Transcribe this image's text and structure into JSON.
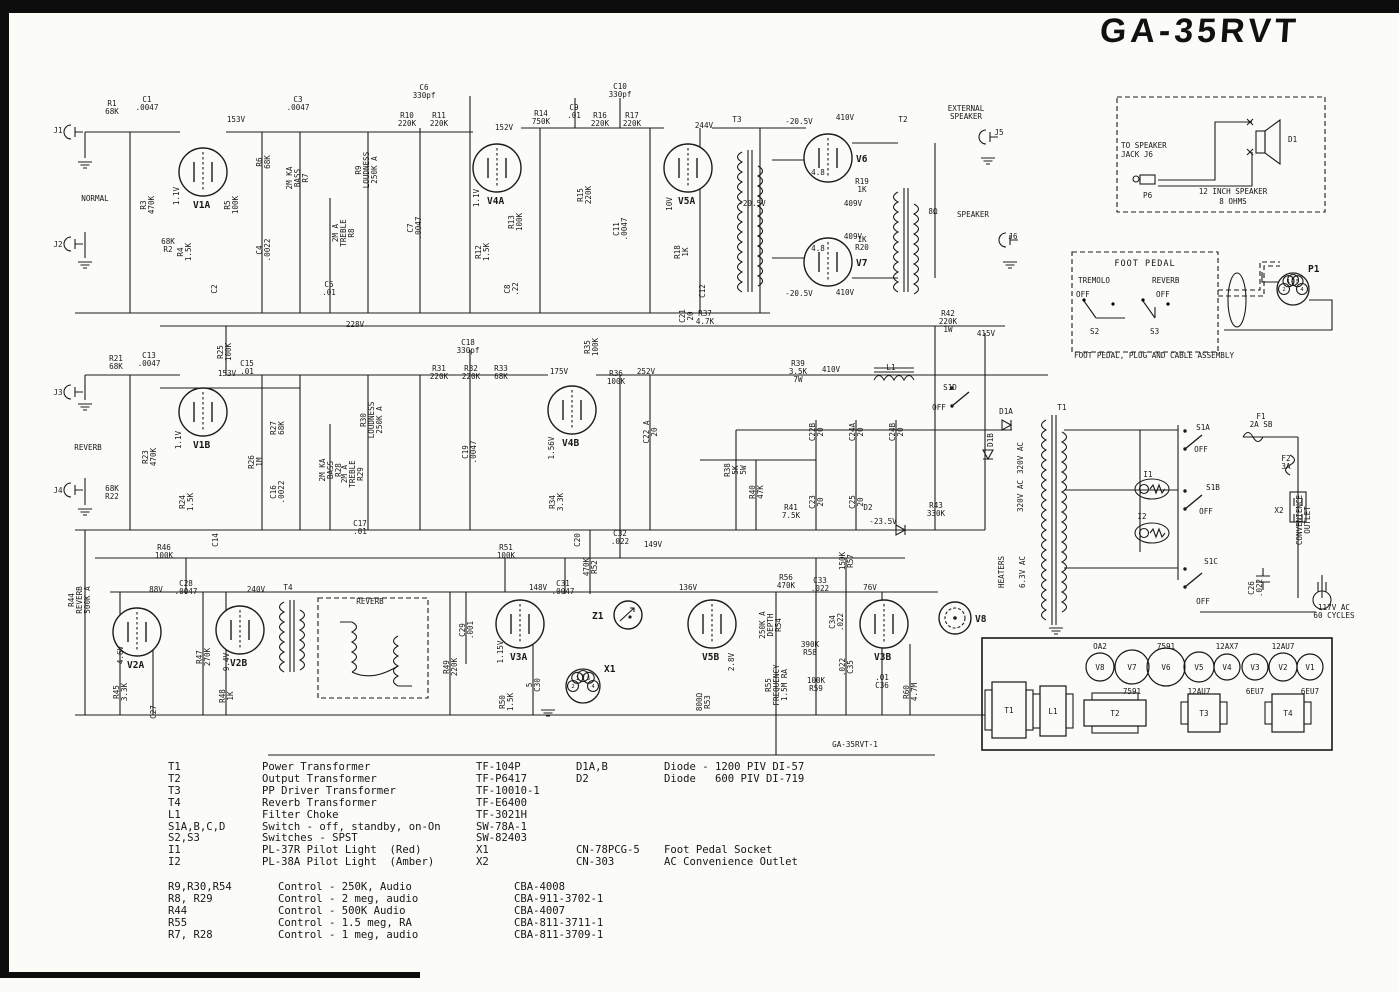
{
  "title": "GA-35RVT",
  "page_note": "GA-35RVT-1",
  "speaker_assembly": {
    "line1": "TO SPEAKER",
    "line2": "JACK J6",
    "plug": "P6",
    "driver": "D1",
    "spec1": "12 INCH SPEAKER",
    "spec2": "8 OHMS"
  },
  "foot_pedal": {
    "title": "FOOT PEDAL",
    "left_label": "TREMOLO",
    "right_label": "REVERB",
    "off_left": "OFF",
    "off_right": "OFF",
    "s2": "S2",
    "s3": "S3",
    "plug": "P1",
    "caption": "FOOT PEDAL, PLUG AND CABLE ASSEMBLY"
  },
  "chassis": {
    "tubes": [
      {
        "n": "V8",
        "x": 1100,
        "r": 14,
        "top": "OA2"
      },
      {
        "n": "V7",
        "x": 1132,
        "r": 17,
        "bottom": "7591"
      },
      {
        "n": "V6",
        "x": 1166,
        "r": 19,
        "top": "7591"
      },
      {
        "n": "V5",
        "x": 1199,
        "r": 15,
        "bottom": "12AU7"
      },
      {
        "n": "V4",
        "x": 1227,
        "r": 13,
        "top": "12AX7"
      },
      {
        "n": "V3",
        "x": 1255,
        "r": 13,
        "bottom": "6EU7"
      },
      {
        "n": "V2",
        "x": 1283,
        "r": 14,
        "top": "12AU7"
      },
      {
        "n": "V1",
        "x": 1310,
        "r": 13,
        "bottom": "6EU7"
      }
    ],
    "transformers": [
      {
        "n": "T1",
        "x": 992,
        "y": 682,
        "w": 34,
        "h": 56,
        "side": "v"
      },
      {
        "n": "L1",
        "x": 1040,
        "y": 686,
        "w": 26,
        "h": 50,
        "side": "v"
      },
      {
        "n": "T2",
        "x": 1084,
        "y": 700,
        "w": 62,
        "h": 26,
        "side": "h"
      },
      {
        "n": "T3",
        "x": 1188,
        "y": 694,
        "w": 32,
        "h": 38,
        "side": "v"
      },
      {
        "n": "T4",
        "x": 1272,
        "y": 694,
        "w": 32,
        "h": 38,
        "side": "v"
      }
    ]
  },
  "parts_list": [
    [
      "T1",
      "Power Transformer",
      "TF-104P",
      "D1A,B",
      "Diode - 1200 PIV DI-57"
    ],
    [
      "T2",
      "Output Transformer",
      "TF-P6417",
      "D2",
      "Diode   600 PIV DI-719"
    ],
    [
      "T3",
      "PP Driver Transformer",
      "TF-10010-1",
      "",
      ""
    ],
    [
      "T4",
      "Reverb Transformer",
      "TF-E6400",
      "",
      ""
    ],
    [
      "L1",
      "Filter Choke",
      "TF-3021H",
      "",
      ""
    ],
    [
      "S1A,B,C,D",
      "Switch - off, standby, on-On",
      "SW-78A-1",
      "",
      ""
    ],
    [
      "S2,S3",
      "Switches - SPST",
      "SW-82403",
      "",
      ""
    ],
    [
      "I1",
      "PL-37R Pilot Light  (Red)",
      "X1",
      "CN-78PCG-5",
      "Foot Pedal Socket"
    ],
    [
      "I2",
      "PL-38A Pilot Light  (Amber)",
      "X2",
      "CN-303",
      "AC Convenience Outlet"
    ]
  ],
  "controls_list": [
    [
      "R9,R30,R54",
      "Control - 250K, Audio",
      "CBA-4008"
    ],
    [
      "R8, R29",
      "Control - 2 meg, audio",
      "CBA-911-3702-1"
    ],
    [
      "R44",
      "Control - 500K Audio",
      "CBA-4007"
    ],
    [
      "R55",
      "Control - 1.5 meg, RA",
      "CBA-811-3711-1"
    ],
    [
      "R7, R28",
      "Control - 1 meg, audio",
      "CBA-811-3709-1"
    ]
  ],
  "schematic": {
    "tubes": [
      {
        "n": "V1A",
        "x": 203,
        "y": 172,
        "r": 24
      },
      {
        "n": "V4A",
        "x": 497,
        "y": 168,
        "r": 24
      },
      {
        "n": "V5A",
        "x": 688,
        "y": 168,
        "r": 24
      },
      {
        "n": "V6",
        "x": 828,
        "y": 158,
        "r": 24,
        "lp": "right"
      },
      {
        "n": "V7",
        "x": 828,
        "y": 262,
        "r": 24,
        "lp": "right"
      },
      {
        "n": "V1B",
        "x": 203,
        "y": 412,
        "r": 24
      },
      {
        "n": "V4B",
        "x": 572,
        "y": 410,
        "r": 24
      },
      {
        "n": "V2A",
        "x": 137,
        "y": 632,
        "r": 24
      },
      {
        "n": "V2B",
        "x": 240,
        "y": 630,
        "r": 24
      },
      {
        "n": "V3A",
        "x": 520,
        "y": 624,
        "r": 24
      },
      {
        "n": "V5B",
        "x": 712,
        "y": 624,
        "r": 24
      },
      {
        "n": "V3B",
        "x": 884,
        "y": 624,
        "r": 24
      },
      {
        "n": "V8",
        "x": 955,
        "y": 618,
        "r": 16,
        "lp": "right",
        "type": "reg"
      },
      {
        "n": "Z1",
        "x": 628,
        "y": 615,
        "r": 14,
        "lp": "left",
        "type": "z"
      }
    ],
    "sockets": [
      {
        "n": "X1",
        "x": 583,
        "y": 686,
        "r": 17,
        "lx": 604,
        "ly": 672,
        "pins": [
          [
            -90,
            "3"
          ],
          [
            180,
            "2"
          ],
          [
            235,
            "1"
          ],
          [
            305,
            "5"
          ],
          [
            0,
            "4"
          ]
        ]
      },
      {
        "n": "P1",
        "x": 1293,
        "y": 289,
        "r": 16,
        "lx": 1308,
        "ly": 272,
        "pins": [
          [
            -90,
            "3"
          ],
          [
            180,
            "2"
          ],
          [
            240,
            "1"
          ],
          [
            300,
            "5"
          ],
          [
            0,
            "4"
          ]
        ]
      }
    ],
    "labels": [
      [
        58,
        130,
        "J1"
      ],
      [
        95,
        198,
        "NORMAL"
      ],
      [
        58,
        244,
        "J2"
      ],
      [
        112,
        107,
        "R1|68K"
      ],
      [
        147,
        103,
        "C1|.0047"
      ],
      [
        236,
        119,
        "153V"
      ],
      [
        298,
        103,
        "C3|.0047"
      ],
      [
        168,
        245,
        "68K|R2"
      ],
      [
        147,
        205,
        "R3|470K",
        1
      ],
      [
        176,
        196,
        "1.1V",
        1
      ],
      [
        184,
        252,
        "R4|1.5K",
        1
      ],
      [
        214,
        289,
        "C2",
        1
      ],
      [
        231,
        205,
        "R5|100K",
        1
      ],
      [
        263,
        162,
        "R6|68K",
        1
      ],
      [
        263,
        250,
        "C4|.0022",
        1
      ],
      [
        297,
        178,
        "2M KA|BASS|R7",
        1
      ],
      [
        343,
        233,
        "2M A|TREBLE|R8",
        1
      ],
      [
        366,
        170,
        "R9|LOUDNESS|250K A",
        1
      ],
      [
        329,
        288,
        "C5|.01"
      ],
      [
        424,
        91,
        "C6|330pf"
      ],
      [
        407,
        119,
        "R10|220K"
      ],
      [
        439,
        119,
        "R11|220K"
      ],
      [
        414,
        228,
        "C7|.0047",
        1
      ],
      [
        504,
        127,
        "152V"
      ],
      [
        476,
        198,
        "1.1V",
        1
      ],
      [
        482,
        252,
        "R12|1.5K",
        1
      ],
      [
        515,
        222,
        "R13|100K",
        1
      ],
      [
        511,
        289,
        "C8|.22",
        1
      ],
      [
        541,
        117,
        "R14|750K"
      ],
      [
        574,
        111,
        "C9|.01"
      ],
      [
        620,
        90,
        "C10|330pf"
      ],
      [
        584,
        195,
        "R15|220K",
        1
      ],
      [
        600,
        119,
        "R16|220K"
      ],
      [
        632,
        119,
        "R17|220K"
      ],
      [
        620,
        229,
        "C11|.0047",
        1
      ],
      [
        704,
        125,
        "244V"
      ],
      [
        669,
        204,
        "10V",
        1
      ],
      [
        681,
        252,
        "R18|1K",
        1
      ],
      [
        702,
        291,
        "C12",
        1
      ],
      [
        737,
        119,
        "T3"
      ],
      [
        799,
        121,
        "-20.5V"
      ],
      [
        752,
        203,
        "-20.5V"
      ],
      [
        799,
        293,
        "-20.5V"
      ],
      [
        845,
        117,
        "410V"
      ],
      [
        845,
        292,
        "410V"
      ],
      [
        818,
        172,
        "4.8"
      ],
      [
        818,
        248,
        "4.8"
      ],
      [
        862,
        185,
        "R19|1K"
      ],
      [
        853,
        203,
        "409V"
      ],
      [
        853,
        236,
        "409V"
      ],
      [
        862,
        243,
        "1K|R20"
      ],
      [
        903,
        119,
        "T2"
      ],
      [
        933,
        211,
        "8Ω"
      ],
      [
        966,
        112,
        "EXTERNAL|SPEAKER"
      ],
      [
        999,
        132,
        "J5"
      ],
      [
        973,
        214,
        "SPEAKER"
      ],
      [
        1013,
        236,
        "J6"
      ],
      [
        355,
        324,
        "228V"
      ],
      [
        705,
        317,
        "R37|4.7K"
      ],
      [
        686,
        316,
        "C21|20",
        1
      ],
      [
        58,
        392,
        "J3"
      ],
      [
        88,
        447,
        "REVERB"
      ],
      [
        58,
        490,
        "J4"
      ],
      [
        116,
        362,
        "R21|68K"
      ],
      [
        149,
        359,
        "C13|.0047"
      ],
      [
        227,
        373,
        "153V"
      ],
      [
        112,
        492,
        "68K|R22"
      ],
      [
        149,
        457,
        "R23|470K",
        1
      ],
      [
        178,
        440,
        "1.1V",
        1
      ],
      [
        186,
        502,
        "R24|1.5K",
        1
      ],
      [
        215,
        540,
        "C14",
        1
      ],
      [
        224,
        352,
        "R25|100K",
        1
      ],
      [
        247,
        367,
        "C15|.01"
      ],
      [
        255,
        462,
        "R26|1M",
        1
      ],
      [
        277,
        428,
        "R27|68K",
        1
      ],
      [
        277,
        492,
        "C16|.0022",
        1
      ],
      [
        330,
        470,
        "2M KA|BASS|R28",
        1
      ],
      [
        352,
        474,
        "2M A|TREBLE|R29",
        1
      ],
      [
        371,
        420,
        "R30|LOUDNESS|250K A",
        1
      ],
      [
        360,
        527,
        "C17|.01"
      ],
      [
        468,
        346,
        "C18|330pf"
      ],
      [
        439,
        372,
        "R31|220K"
      ],
      [
        471,
        372,
        "R32|220K"
      ],
      [
        501,
        372,
        "R33|68K"
      ],
      [
        469,
        452,
        "C19|.0047",
        1
      ],
      [
        559,
        371,
        "175V"
      ],
      [
        551,
        448,
        "1.56V",
        1
      ],
      [
        556,
        502,
        "R34|3.3K",
        1
      ],
      [
        577,
        540,
        "C20",
        1
      ],
      [
        591,
        347,
        "R35|100K",
        1
      ],
      [
        616,
        377,
        "R36|100K"
      ],
      [
        646,
        371,
        "252V"
      ],
      [
        650,
        432,
        "C22 A|20",
        1
      ],
      [
        735,
        470,
        "R38|5K|5W",
        1
      ],
      [
        798,
        371,
        "R39|3.5K|7W"
      ],
      [
        831,
        369,
        "410V"
      ],
      [
        891,
        367,
        "L1"
      ],
      [
        948,
        321,
        "R42|220K|1W"
      ],
      [
        986,
        333,
        "415V"
      ],
      [
        950,
        387,
        "S1D"
      ],
      [
        939,
        407,
        "OFF"
      ],
      [
        1006,
        411,
        "D1A"
      ],
      [
        990,
        440,
        "D1B",
        1
      ],
      [
        816,
        432,
        "C22B|20",
        1
      ],
      [
        816,
        502,
        "C23|20",
        1
      ],
      [
        856,
        432,
        "C24A|20",
        1
      ],
      [
        856,
        502,
        "C25|20",
        1
      ],
      [
        896,
        432,
        "C24B|20",
        1
      ],
      [
        756,
        492,
        "R40|47K",
        1
      ],
      [
        791,
        511,
        "R41|7.5K"
      ],
      [
        868,
        507,
        "D2"
      ],
      [
        883,
        521,
        "-23.5V"
      ],
      [
        936,
        509,
        "R43|330K"
      ],
      [
        1020,
        458,
        "320V AC",
        1
      ],
      [
        1020,
        496,
        "320V AC",
        1
      ],
      [
        1001,
        572,
        "HEATERS",
        1
      ],
      [
        1022,
        572,
        "6.3V AC",
        1
      ],
      [
        1062,
        407,
        "T1"
      ],
      [
        1203,
        427,
        "S1A"
      ],
      [
        1201,
        449,
        "OFF"
      ],
      [
        1261,
        420,
        "F1|2A SB"
      ],
      [
        1286,
        462,
        "F2|3A"
      ],
      [
        1213,
        487,
        "S1B"
      ],
      [
        1206,
        511,
        "OFF"
      ],
      [
        1148,
        474,
        "I1"
      ],
      [
        1142,
        516,
        "I2"
      ],
      [
        1211,
        561,
        "S1C"
      ],
      [
        1203,
        601,
        "OFF"
      ],
      [
        1255,
        588,
        "C26|.022",
        1
      ],
      [
        1279,
        510,
        "X2"
      ],
      [
        1303,
        520,
        "CONVENIENCE|OUTLET",
        1
      ],
      [
        1334,
        611,
        "117V AC|60 CYCLES"
      ],
      [
        79,
        600,
        "R44|REVERB|500K A",
        1
      ],
      [
        156,
        589,
        "88V"
      ],
      [
        120,
        655,
        "4.6V",
        1
      ],
      [
        120,
        692,
        "R45|3.3K",
        1
      ],
      [
        153,
        712,
        "C27",
        1
      ],
      [
        186,
        587,
        "C28|.0047"
      ],
      [
        203,
        657,
        "R47|270K",
        1
      ],
      [
        256,
        589,
        "240V"
      ],
      [
        226,
        662,
        "9.4V",
        1
      ],
      [
        226,
        696,
        "R48|1K",
        1
      ],
      [
        288,
        587,
        "T4"
      ],
      [
        370,
        601,
        "REVERB"
      ],
      [
        164,
        551,
        "R46|100K"
      ],
      [
        450,
        667,
        "R49|220K",
        1
      ],
      [
        466,
        630,
        "C29|.001",
        1
      ],
      [
        506,
        551,
        "R51|100K"
      ],
      [
        538,
        587,
        "148V"
      ],
      [
        500,
        652,
        "1.15V",
        1
      ],
      [
        506,
        702,
        "R50|1.5K",
        1
      ],
      [
        533,
        685,
        "5|C30",
        1
      ],
      [
        563,
        587,
        "C31|.0047"
      ],
      [
        590,
        567,
        "470K|R52",
        1
      ],
      [
        620,
        537,
        "C32|.022"
      ],
      [
        653,
        544,
        "149V"
      ],
      [
        688,
        587,
        "136V"
      ],
      [
        731,
        662,
        "2.8V",
        1
      ],
      [
        703,
        702,
        "800Ω|R53",
        1
      ],
      [
        786,
        581,
        "R56|470K"
      ],
      [
        820,
        584,
        "C33|.022"
      ],
      [
        846,
        561,
        "150K|R57",
        1
      ],
      [
        770,
        625,
        "250K A|DEPTH|R54",
        1
      ],
      [
        810,
        648,
        "390K|R58"
      ],
      [
        836,
        622,
        "C34|.022",
        1
      ],
      [
        776,
        685,
        "R55|FREQUENCY|1.5M RA",
        1
      ],
      [
        816,
        684,
        "100K|R59"
      ],
      [
        846,
        667,
        ".022|C35",
        1
      ],
      [
        882,
        681,
        ".01|C36"
      ],
      [
        870,
        587,
        "76V"
      ],
      [
        910,
        692,
        "R60|4.7M",
        1
      ],
      [
        855,
        744,
        "GA-35RVT-1"
      ]
    ]
  }
}
